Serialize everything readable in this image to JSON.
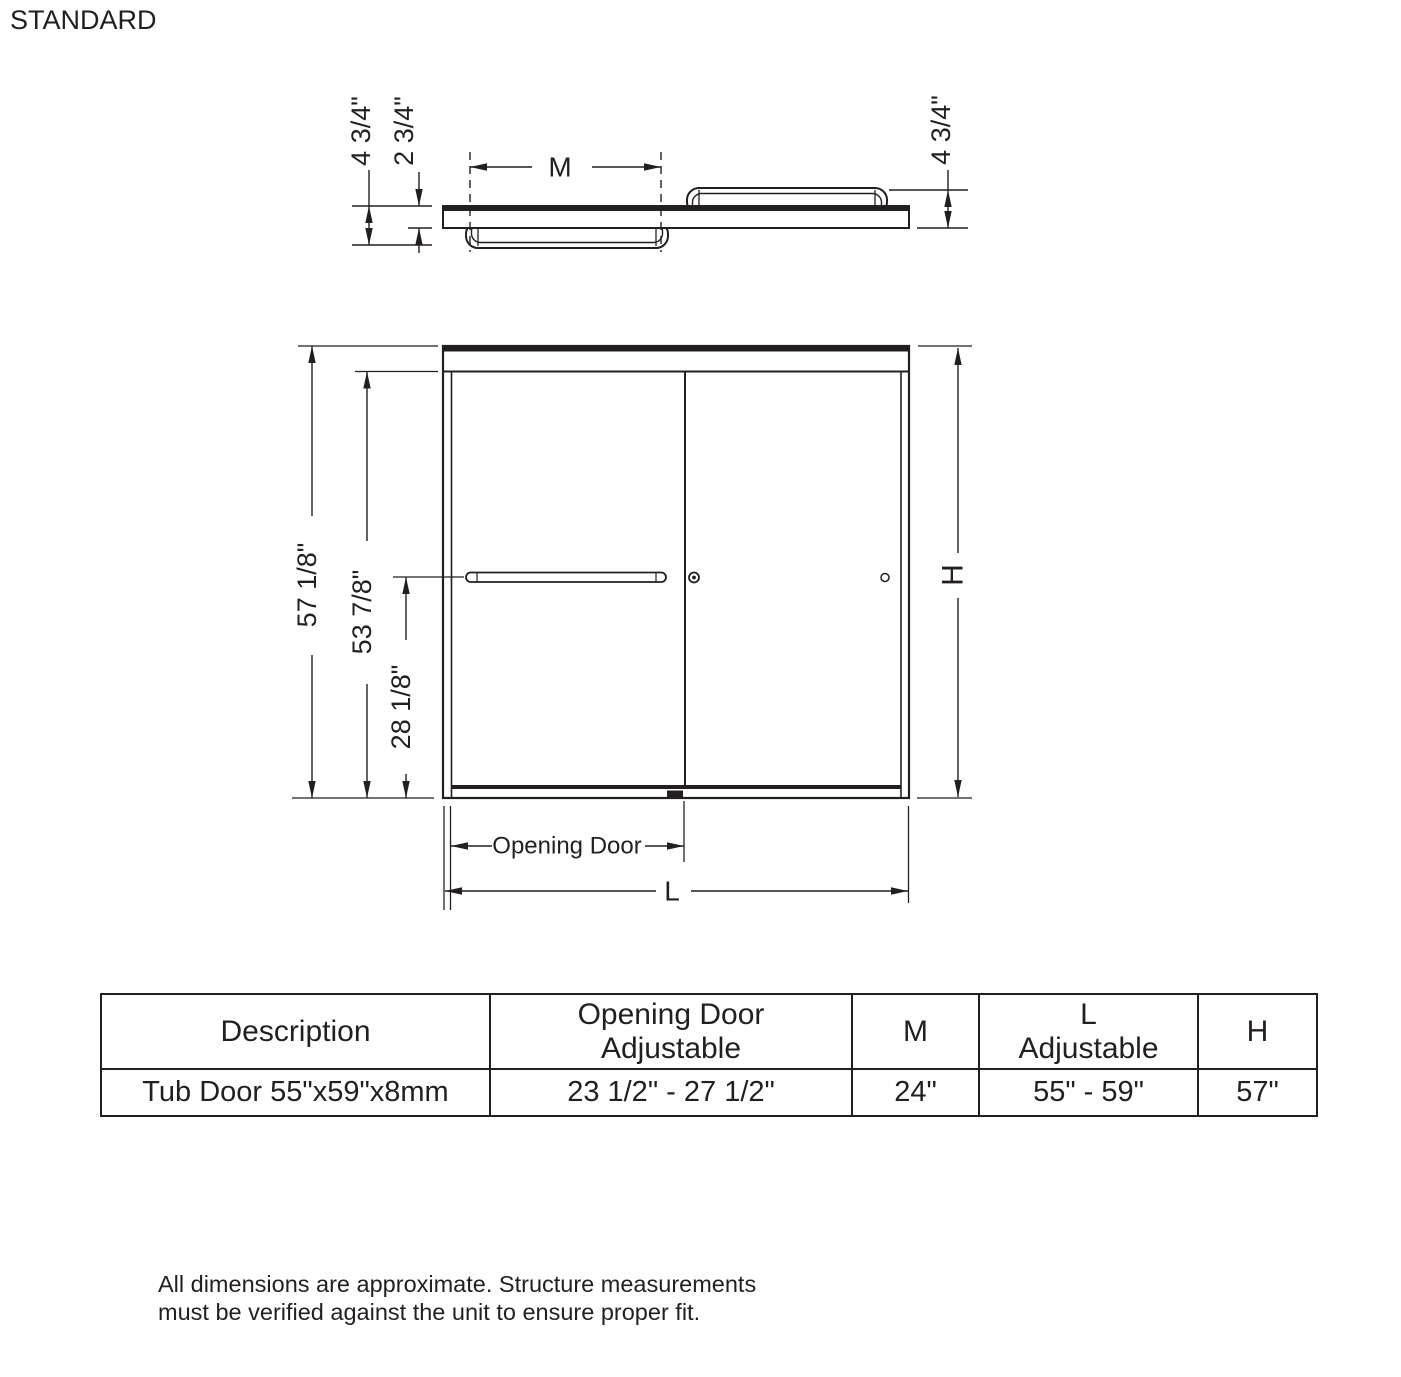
{
  "title": "STANDARD",
  "colors": {
    "line": "#231f20",
    "background": "#ffffff"
  },
  "top_view": {
    "dim_left_outer": "4 3/4\"",
    "dim_left_inner": "2 3/4\"",
    "dim_right": "4 3/4\"",
    "dim_width_label": "M"
  },
  "front_view": {
    "dim_total_height": "57 1/8\"",
    "dim_panel_height": "53 7/8\"",
    "dim_towel_bar_height": "28 1/8\"",
    "dim_height_label": "H",
    "dim_opening_label": "Opening Door",
    "dim_length_label": "L"
  },
  "table": {
    "headers": [
      {
        "line1": "Description",
        "line2": ""
      },
      {
        "line1": "Opening Door",
        "line2": "Adjustable"
      },
      {
        "line1": "M",
        "line2": ""
      },
      {
        "line1": "L",
        "line2": "Adjustable"
      },
      {
        "line1": "H",
        "line2": ""
      }
    ],
    "rows": [
      [
        "Tub Door 55\"x59\"x8mm",
        "23 1/2\" - 27 1/2\"",
        "24\"",
        "55\" - 59\"",
        "57\""
      ]
    ]
  },
  "footnote": {
    "line1": "All dimensions are approximate. Structure measurements",
    "line2": "must be verified against the unit to ensure proper fit."
  }
}
